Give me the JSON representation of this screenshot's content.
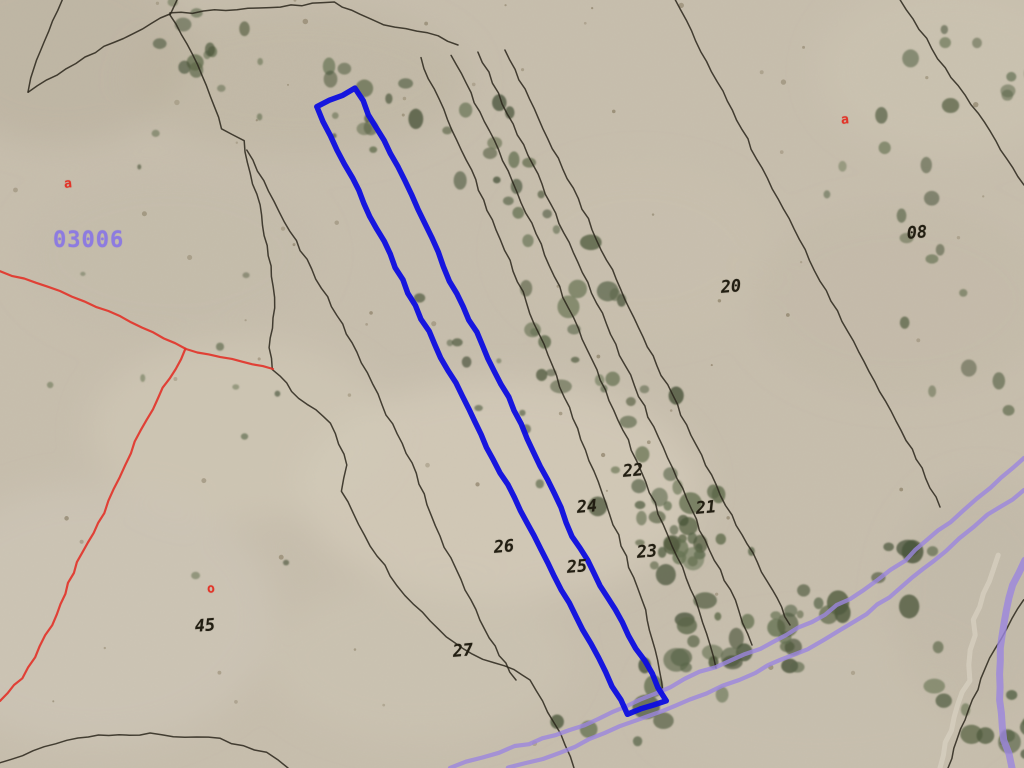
{
  "map": {
    "background_color": "#c7bead",
    "selected_parcel_color": "#0d0de0",
    "boundary_color": "#2a261b",
    "red_boundary_color": "#e23228",
    "road_color": "#9b86de",
    "parcel_label_color": "#221e12",
    "zone_label_color": "#8d7be0",
    "marker_color": "#e23428"
  },
  "labels": {
    "zone_code": {
      "text": "03006",
      "x": 53,
      "y": 228
    },
    "markers": [
      {
        "text": "a",
        "x": 68,
        "y": 184
      },
      {
        "text": "a",
        "x": 845,
        "y": 120
      },
      {
        "text": "o",
        "x": 211,
        "y": 589
      }
    ],
    "parcels": [
      {
        "text": "08",
        "x": 917,
        "y": 233
      },
      {
        "text": "20",
        "x": 731,
        "y": 287
      },
      {
        "text": "22",
        "x": 633,
        "y": 471
      },
      {
        "text": "21",
        "x": 706,
        "y": 508
      },
      {
        "text": "24",
        "x": 587,
        "y": 507
      },
      {
        "text": "23",
        "x": 647,
        "y": 552
      },
      {
        "text": "26",
        "x": 504,
        "y": 547
      },
      {
        "text": "25",
        "x": 577,
        "y": 567
      },
      {
        "text": "27",
        "x": 463,
        "y": 651
      },
      {
        "text": "45",
        "x": 205,
        "y": 626
      }
    ]
  },
  "geometry": {
    "selected_parcel": {
      "points": [
        [
          317,
          107
        ],
        [
          355,
          88
        ],
        [
          405,
          180
        ],
        [
          450,
          281
        ],
        [
          515,
          410
        ],
        [
          573,
          536
        ],
        [
          622,
          622
        ],
        [
          666,
          700
        ],
        [
          628,
          714
        ],
        [
          583,
          630
        ],
        [
          533,
          536
        ],
        [
          468,
          409
        ],
        [
          402,
          280
        ],
        [
          352,
          178
        ]
      ]
    },
    "boundaries": [
      [
        [
          62,
          0
        ],
        [
          44,
          42
        ],
        [
          30,
          78
        ],
        [
          28,
          92
        ]
      ],
      [
        [
          28,
          92
        ],
        [
          95,
          52
        ],
        [
          170,
          14
        ]
      ],
      [
        [
          170,
          14
        ],
        [
          177,
          0
        ]
      ],
      [
        [
          170,
          14
        ],
        [
          248,
          8
        ],
        [
          334,
          3
        ],
        [
          360,
          14
        ],
        [
          384,
          24
        ],
        [
          428,
          32
        ],
        [
          458,
          45
        ]
      ],
      [
        [
          170,
          14
        ],
        [
          197,
          65
        ],
        [
          222,
          128
        ],
        [
          243,
          141
        ],
        [
          259,
          205
        ],
        [
          270,
          266
        ],
        [
          275,
          308
        ],
        [
          268,
          348
        ],
        [
          273,
          369
        ],
        [
          299,
          398
        ],
        [
          331,
          423
        ],
        [
          347,
          465
        ],
        [
          342,
          491
        ],
        [
          359,
          524
        ],
        [
          377,
          556
        ],
        [
          405,
          595
        ],
        [
          438,
          630
        ],
        [
          472,
          655
        ],
        [
          505,
          665
        ],
        [
          530,
          680
        ],
        [
          548,
          712
        ],
        [
          566,
          745
        ],
        [
          574,
          768
        ]
      ],
      [
        [
          247,
          150
        ],
        [
          285,
          222
        ],
        [
          322,
          288
        ],
        [
          357,
          352
        ],
        [
          382,
          405
        ],
        [
          407,
          453
        ],
        [
          424,
          494
        ],
        [
          440,
          536
        ],
        [
          460,
          580
        ],
        [
          480,
          620
        ],
        [
          500,
          655
        ],
        [
          516,
          680
        ]
      ],
      [
        [
          420,
          58
        ],
        [
          462,
          150
        ],
        [
          505,
          250
        ],
        [
          548,
          355
        ],
        [
          585,
          450
        ],
        [
          618,
          535
        ],
        [
          645,
          610
        ],
        [
          660,
          670
        ],
        [
          663,
          693
        ]
      ],
      [
        [
          452,
          55
        ],
        [
          498,
          150
        ],
        [
          545,
          255
        ],
        [
          592,
          360
        ],
        [
          632,
          450
        ],
        [
          668,
          535
        ],
        [
          695,
          600
        ],
        [
          710,
          645
        ],
        [
          716,
          668
        ]
      ],
      [
        [
          478,
          52
        ],
        [
          528,
          155
        ],
        [
          578,
          262
        ],
        [
          625,
          365
        ],
        [
          668,
          458
        ],
        [
          705,
          540
        ],
        [
          735,
          600
        ],
        [
          752,
          645
        ]
      ],
      [
        [
          505,
          50
        ],
        [
          558,
          158
        ],
        [
          612,
          270
        ],
        [
          662,
          375
        ],
        [
          706,
          465
        ],
        [
          742,
          535
        ],
        [
          772,
          590
        ],
        [
          790,
          625
        ]
      ],
      [
        [
          675,
          0
        ],
        [
          717,
          82
        ],
        [
          762,
          168
        ],
        [
          810,
          260
        ],
        [
          858,
          352
        ],
        [
          907,
          440
        ],
        [
          926,
          478
        ],
        [
          940,
          507
        ]
      ],
      [
        [
          900,
          0
        ],
        [
          945,
          68
        ],
        [
          990,
          132
        ],
        [
          1024,
          185
        ]
      ],
      [
        [
          1024,
          600
        ],
        [
          995,
          648
        ],
        [
          968,
          710
        ],
        [
          948,
          768
        ]
      ],
      [
        [
          0,
          762
        ],
        [
          78,
          737
        ],
        [
          150,
          734
        ],
        [
          220,
          739
        ],
        [
          266,
          753
        ],
        [
          288,
          768
        ]
      ]
    ],
    "red_lines": [
      [
        [
          0,
          271
        ],
        [
          60,
          291
        ],
        [
          120,
          317
        ],
        [
          186,
          349
        ],
        [
          232,
          359
        ],
        [
          273,
          369
        ]
      ],
      [
        [
          186,
          349
        ],
        [
          158,
          398
        ],
        [
          130,
          453
        ],
        [
          104,
          513
        ],
        [
          82,
          552
        ],
        [
          52,
          625
        ],
        [
          22,
          678
        ],
        [
          0,
          701
        ]
      ]
    ],
    "roads": [
      [
        [
          450,
          768
        ],
        [
          515,
          747
        ],
        [
          570,
          731
        ],
        [
          640,
          700
        ],
        [
          700,
          673
        ],
        [
          760,
          648
        ],
        [
          812,
          622
        ],
        [
          862,
          590
        ],
        [
          905,
          560
        ],
        [
          950,
          522
        ],
        [
          990,
          487
        ],
        [
          1024,
          458
        ]
      ],
      [
        [
          508,
          768
        ],
        [
          560,
          753
        ],
        [
          620,
          727
        ],
        [
          690,
          700
        ],
        [
          755,
          672
        ],
        [
          808,
          650
        ],
        [
          855,
          622
        ],
        [
          900,
          588
        ],
        [
          945,
          550
        ],
        [
          988,
          515
        ],
        [
          1024,
          490
        ]
      ]
    ],
    "road_curve": [
      [
        1024,
        560
      ],
      [
        1008,
        598
      ],
      [
        1000,
        648
      ],
      [
        999,
        700
      ],
      [
        1004,
        740
      ],
      [
        1012,
        768
      ]
    ]
  }
}
